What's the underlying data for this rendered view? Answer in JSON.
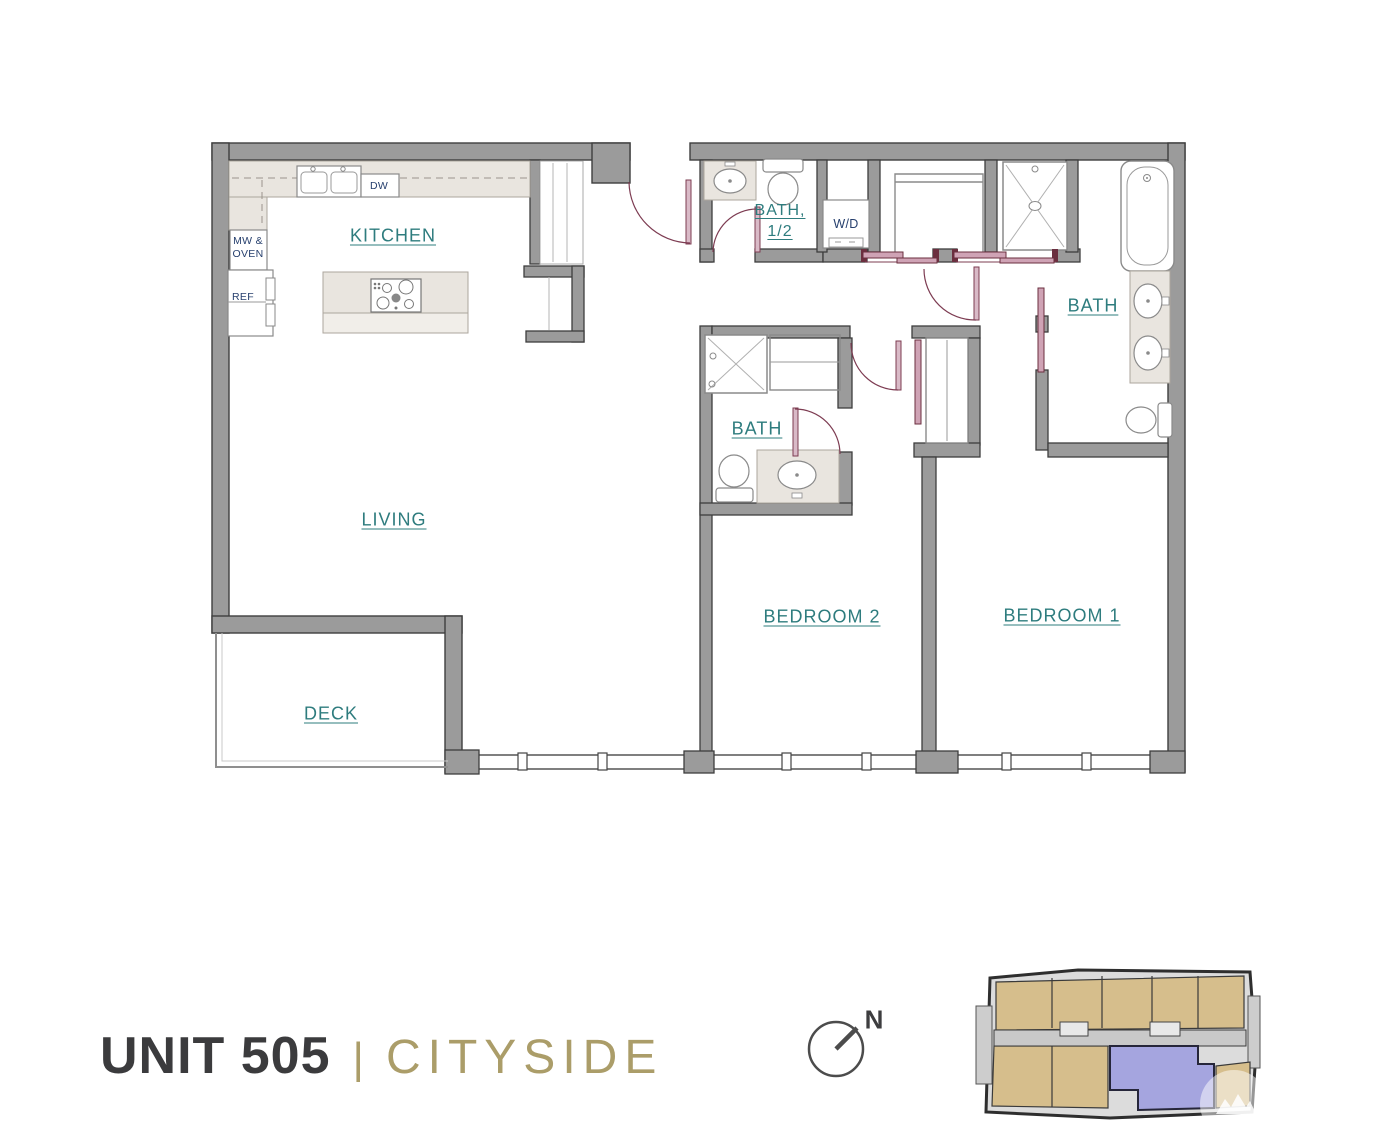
{
  "title": {
    "unit_number": "UNIT 505",
    "separator": "|",
    "plan_name": "CITYSIDE"
  },
  "compass": {
    "north_label": "N"
  },
  "rooms": {
    "kitchen": {
      "label": "KITCHEN"
    },
    "living": {
      "label": "LIVING"
    },
    "deck": {
      "label": "DECK"
    },
    "bedroom_2": {
      "label": "BEDROOM 2"
    },
    "bedroom_1": {
      "label": "BEDROOM 1"
    },
    "bath_half": {
      "label_line_1": "BATH,",
      "label_line_2": "1/2"
    },
    "bath_main": {
      "label": "BATH"
    },
    "bath_2": {
      "label": "BATH"
    }
  },
  "appliances": {
    "microwave_oven_line_1": "MW &",
    "microwave_oven_line_2": "OVEN",
    "refrigerator": "REF",
    "dishwasher": "DW",
    "washer_dryer": "W/D"
  },
  "colors": {
    "room_label_teal": "#2e7c7e",
    "appliance_label_navy": "#27406e",
    "accent_gold": "#ab9d69",
    "title_charcoal": "#3b3b3d",
    "wall_gray": "#9b9b9b",
    "door_maroon": "#7d3c52",
    "counter_beige": "#e9e5df",
    "keyplan_tan": "#d6be8c",
    "keyplan_highlight_blue": "#a5a5df"
  }
}
